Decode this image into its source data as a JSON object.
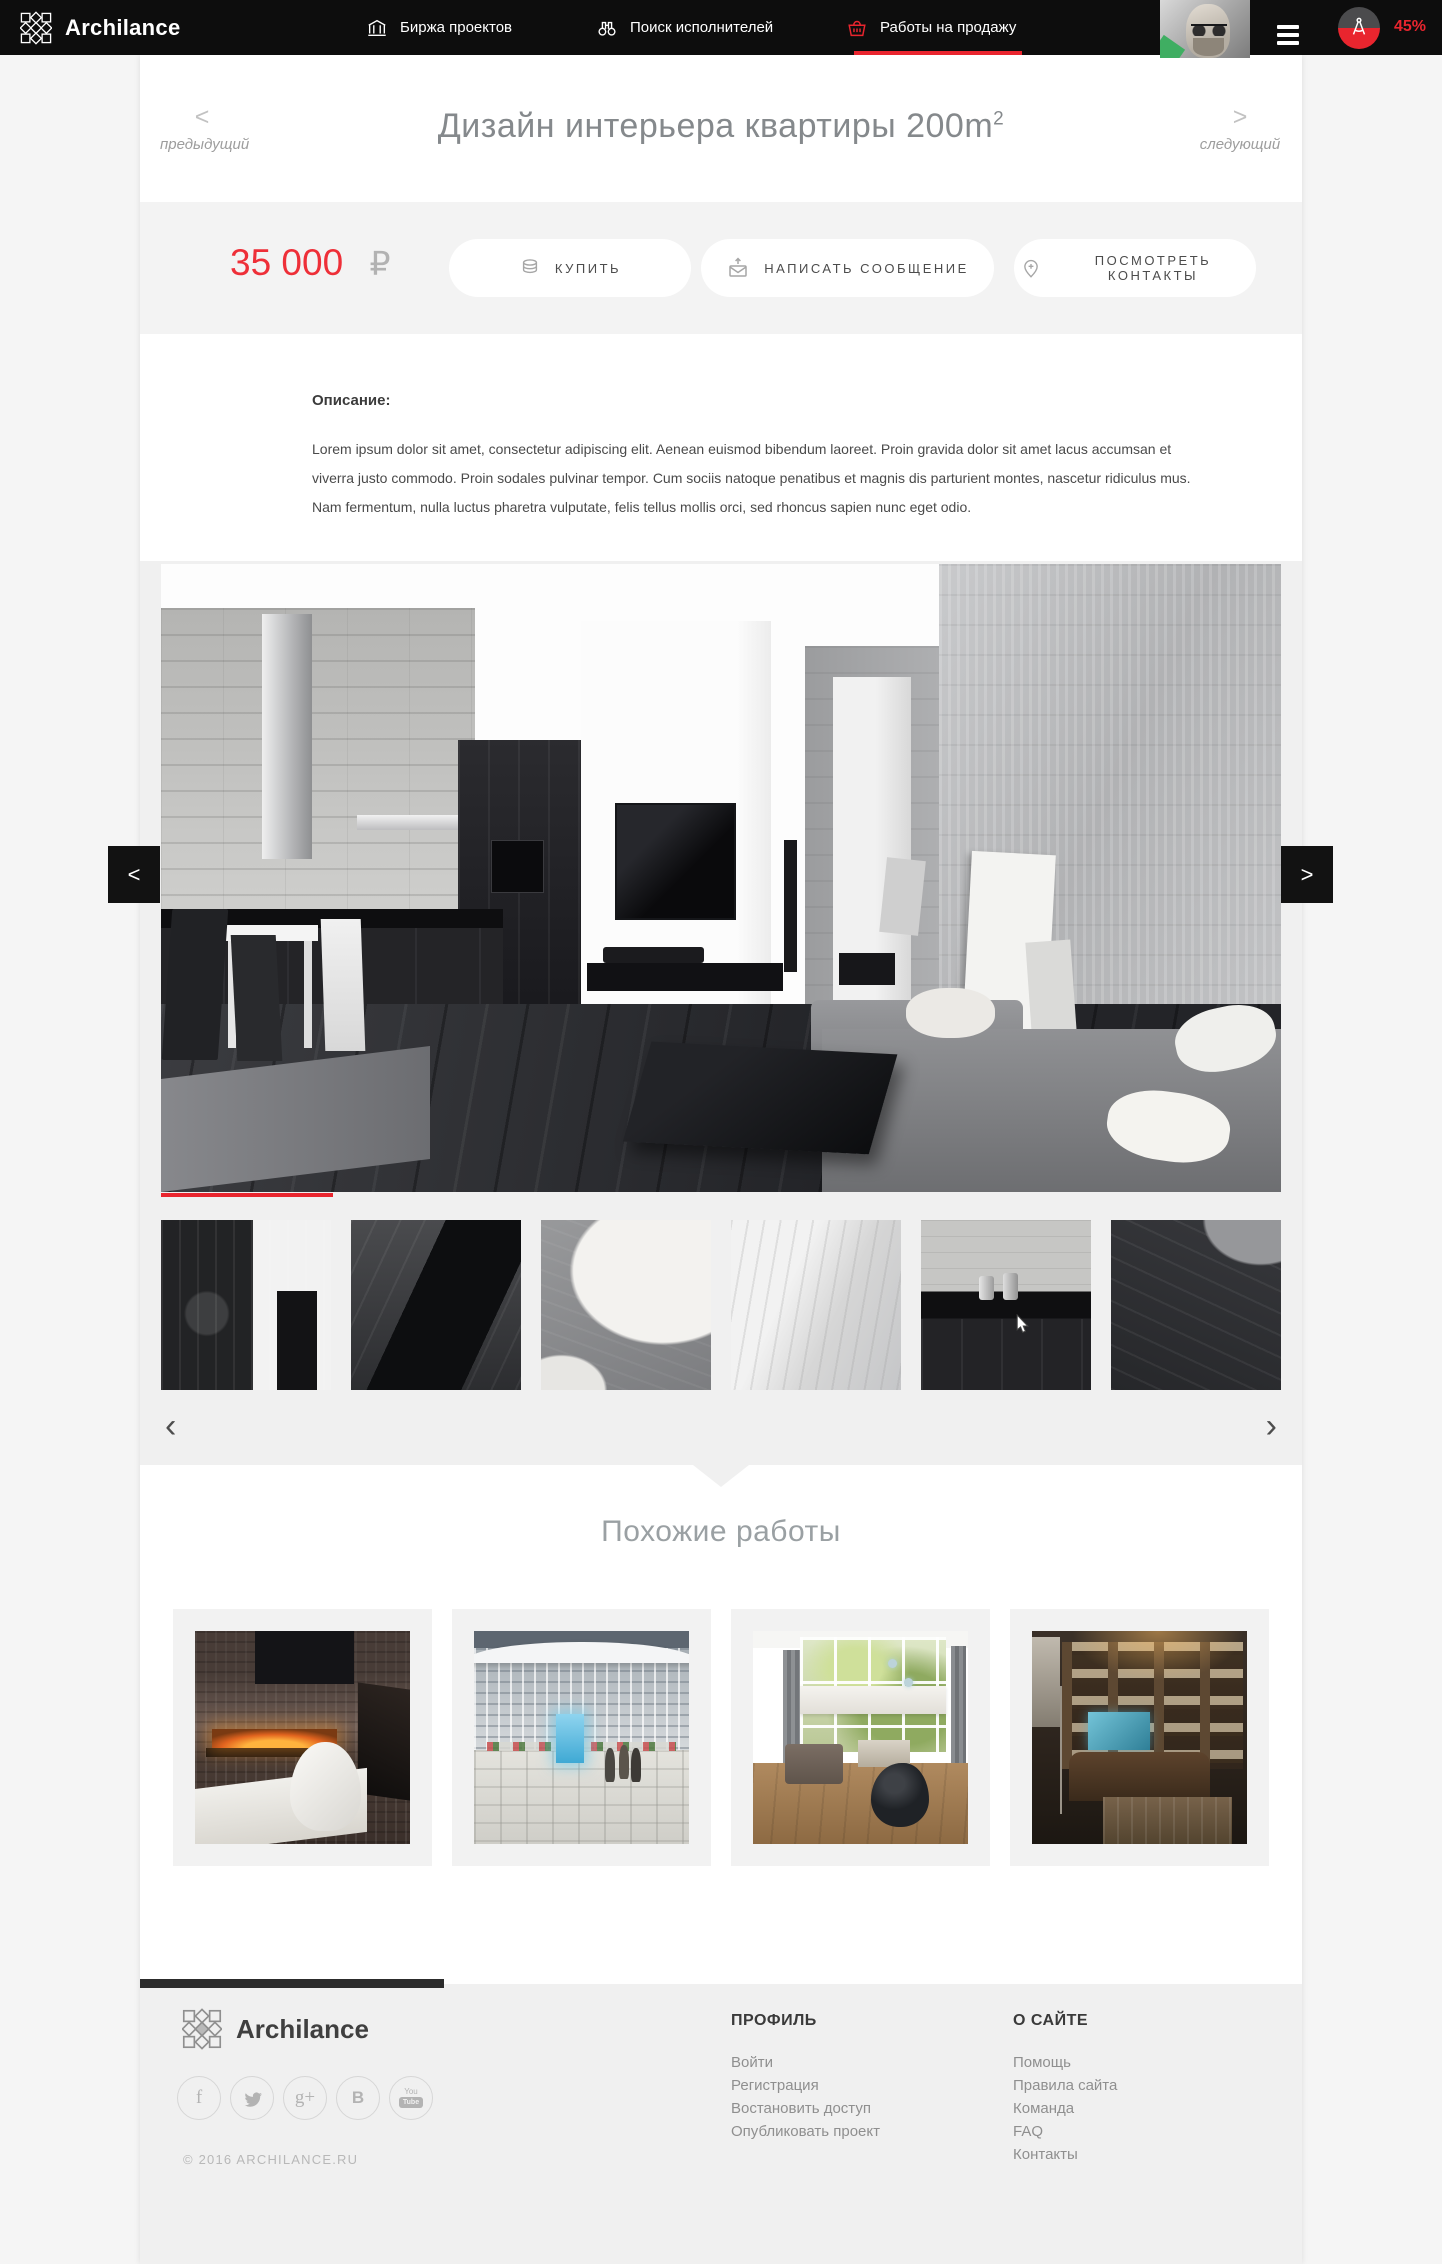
{
  "brand": {
    "name": "Archilance"
  },
  "nav": {
    "items": [
      {
        "label": "Биржа проектов",
        "icon": "bank-icon",
        "active": false
      },
      {
        "label": "Поиск исполнителей",
        "icon": "binoculars-icon",
        "active": false
      },
      {
        "label": "Работы на продажу",
        "icon": "basket-icon",
        "active": true
      }
    ],
    "user": {
      "progress": "45%"
    }
  },
  "titlebar": {
    "title": "Дизайн интерьера квартиры 200m",
    "title_sup": "2",
    "prev_arrow": "<",
    "prev_label": "предыдущий",
    "next_arrow": ">",
    "next_label": "следующий"
  },
  "offer": {
    "price": "35 000",
    "currency": "₽",
    "buy": "Купить",
    "message": "Написать сообщение",
    "contacts": "Посмотреть контакты"
  },
  "description": {
    "label": "Описание:",
    "text": "Lorem ipsum dolor sit amet, consectetur adipiscing elit. Aenean euismod bibendum laoreet. Proin gravida dolor sit amet lacus accumsan et viverra justo commodo. Proin sodales pulvinar tempor. Cum sociis natoque penatibus et magnis dis parturient montes, nascetur ridiculus mus. Nam fermentum, nulla luctus pharetra vulputate, felis tellus mollis orci, sed rhoncus sapien nunc eget odio."
  },
  "gallery": {
    "big_prev": "<",
    "big_next": ">",
    "prev": "‹",
    "next": "›",
    "thumbs": [
      {
        "name": "kitchen-cabinet"
      },
      {
        "name": "black-coffee-table"
      },
      {
        "name": "white-pillows"
      },
      {
        "name": "concrete-doorway"
      },
      {
        "name": "kitchen-counter"
      },
      {
        "name": "sofa-and-floor"
      }
    ]
  },
  "similar": {
    "heading": "Похожие работы",
    "items": [
      {
        "name": "fireplace-lounge"
      },
      {
        "name": "mall-atrium"
      },
      {
        "name": "bright-living-room"
      },
      {
        "name": "home-library"
      }
    ]
  },
  "footer": {
    "brand": "Archilance",
    "copyright": "© 2016 ARCHILANCE.RU",
    "profile": {
      "heading": "ПРОФИЛЬ",
      "links": [
        "Войти",
        "Регистрация",
        "Востановить доступ",
        "Опубликовать проект"
      ]
    },
    "about": {
      "heading": "О САЙТЕ",
      "links": [
        "Помощь",
        "Правила сайта",
        "Команда",
        "FAQ",
        "Контакты"
      ]
    },
    "social_glyphs": {
      "facebook": "f",
      "google_plus": "g+",
      "vk": "В",
      "youtube_top": "You",
      "youtube_bottom": "Tube"
    },
    "socials": [
      "facebook",
      "twitter",
      "google-plus",
      "vk",
      "youtube"
    ]
  },
  "colors": {
    "accent": "#e9252e",
    "nav_bg": "#0d0d0d",
    "section_gray": "#f0f0f0",
    "price_red": "#ee2f38"
  }
}
